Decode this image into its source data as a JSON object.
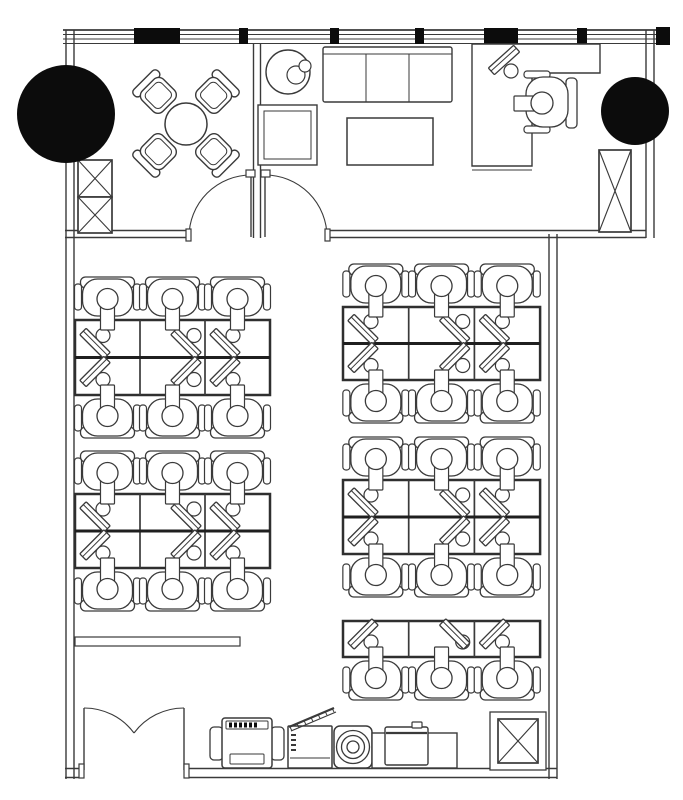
{
  "plan": {
    "canvas": {
      "width": 683,
      "height": 800
    },
    "palette": {
      "background": "#ffffff",
      "line": "#3a3a3a",
      "line_heavy": "#1f1f1f",
      "black_fill": "#0c0c0c",
      "bank_border": "#2f2f2f",
      "white": "#ffffff"
    },
    "window_band": {
      "x1": 63,
      "x2": 656,
      "ys": [
        30,
        34.5,
        39,
        43.5
      ]
    },
    "wall_black_segments": [
      [
        134,
        28,
        46,
        16
      ],
      [
        239,
        28,
        9,
        16
      ],
      [
        330,
        28,
        9,
        16
      ],
      [
        415,
        28,
        9,
        16
      ],
      [
        484,
        28,
        34,
        16
      ],
      [
        577,
        28,
        10,
        16
      ],
      [
        656,
        27,
        14,
        18
      ]
    ],
    "walls": [
      {
        "name": "left-wall",
        "x1": 70,
        "y1": 30,
        "x2": 70,
        "y2": 779,
        "gap": 8
      },
      {
        "name": "upper-right-wall",
        "x1": 650,
        "y1": 30,
        "x2": 650,
        "y2": 238,
        "gap": 8
      },
      {
        "name": "interior-wall-left",
        "x1": 65,
        "y1": 234,
        "x2": 189,
        "y2": 234,
        "gap": 7
      },
      {
        "name": "interior-wall-right",
        "x1": 327,
        "y1": 234,
        "x2": 646,
        "y2": 234,
        "gap": 7
      },
      {
        "name": "room-divider-wall",
        "x1": 257,
        "y1": 44,
        "x2": 257,
        "y2": 238,
        "gap": 7
      },
      {
        "name": "open-office-right-wall",
        "x1": 553,
        "y1": 234,
        "x2": 553,
        "y2": 779,
        "gap": 8
      },
      {
        "name": "bottom-wall-left",
        "x1": 65,
        "y1": 773,
        "x2": 84,
        "y2": 773,
        "gap": 9
      },
      {
        "name": "bottom-wall-right",
        "x1": 184,
        "y1": 773,
        "x2": 557,
        "y2": 773,
        "gap": 9
      }
    ],
    "columns": [
      {
        "name": "column-top-left",
        "cx": 66,
        "cy": 114,
        "r": 49
      },
      {
        "name": "column-top-right",
        "cx": 635,
        "cy": 111,
        "r": 34
      }
    ],
    "x_cabinets": [
      {
        "name": "storage-cabinet-left-upper",
        "x": 78,
        "y": 160,
        "w": 34,
        "h": 37
      },
      {
        "name": "storage-cabinet-left-lower",
        "x": 78,
        "y": 197,
        "w": 34,
        "h": 36
      },
      {
        "name": "storage-cabinet-office",
        "x": 599,
        "y": 150,
        "w": 32,
        "h": 82
      },
      {
        "name": "service-box",
        "x": 498,
        "y": 719,
        "w": 40,
        "h": 44,
        "outer": [
          490,
          712,
          56,
          58
        ]
      }
    ],
    "reception": {
      "table": {
        "cx": 186,
        "cy": 124,
        "r": 21
      },
      "chairs": [
        {
          "cx": 158,
          "cy": 95,
          "rot": -45
        },
        {
          "cx": 214,
          "cy": 95,
          "rot": 45
        },
        {
          "cx": 158,
          "cy": 152,
          "rot": -135
        },
        {
          "cx": 214,
          "cy": 152,
          "rot": 135
        }
      ]
    },
    "lounge": {
      "round_table": {
        "cx": 288,
        "cy": 72,
        "r": 22
      },
      "kettle": [
        {
          "cx": 296,
          "cy": 75,
          "r": 9
        },
        {
          "cx": 305,
          "cy": 66,
          "r": 6
        }
      ],
      "square_table": {
        "x": 258,
        "y": 105,
        "w": 59,
        "h": 60,
        "inset": 6
      },
      "sofa": {
        "x": 323,
        "y": 47,
        "w": 129,
        "h": 55,
        "seat_top": 54,
        "dividers": [
          366,
          409
        ]
      },
      "coffee_table": {
        "x": 347,
        "y": 118,
        "w": 86,
        "h": 47
      }
    },
    "office": {
      "desk_path": "M472 44 L600 44 L600 73 L532 73 L532 166 L472 166 Z",
      "desk_inner_line": [
        472,
        170,
        532,
        170
      ],
      "monitor": {
        "cx": 504,
        "cy": 60,
        "angle": -42,
        "circle": [
          511,
          71,
          6.5
        ]
      },
      "chair": {
        "cx": 546,
        "cy": 103
      },
      "keyboard": {
        "x": 514,
        "y": 96,
        "w": 22,
        "h": 15
      }
    },
    "desk_banks": [
      {
        "name": "desk-bank-left-top",
        "x": 75,
        "y": 320,
        "cols": 3,
        "rows": 2,
        "cell_w": 65,
        "cell_h": 37.5,
        "chairs": "both",
        "monitor_dx": [
          20,
          46,
          20
        ]
      },
      {
        "name": "desk-bank-left-bottom",
        "x": 75,
        "y": 494,
        "cols": 3,
        "rows": 2,
        "cell_w": 65,
        "cell_h": 37,
        "chairs": "both",
        "monitor_dx": [
          20,
          46,
          20
        ]
      },
      {
        "name": "desk-bank-right-top",
        "x": 343,
        "y": 307,
        "cols": 3,
        "rows": 2,
        "cell_w": 65.7,
        "cell_h": 36.5,
        "chairs": "both",
        "monitor_dx": [
          20,
          46,
          20
        ]
      },
      {
        "name": "desk-bank-right-middle",
        "x": 343,
        "y": 480,
        "cols": 3,
        "rows": 2,
        "cell_w": 65.7,
        "cell_h": 37,
        "chairs": "both",
        "monitor_dx": [
          20,
          46,
          20
        ]
      },
      {
        "name": "desk-bank-right-bottom",
        "x": 343,
        "y": 621,
        "cols": 3,
        "rows": 1,
        "cell_w": 65.7,
        "cell_h": 36,
        "chairs": "bottom",
        "monitor_dx": [
          20,
          46,
          20
        ],
        "monitor_angles": [
          -45,
          45,
          -45
        ]
      }
    ],
    "equipment": {
      "low_cabinet": {
        "x": 75,
        "y": 637,
        "w": 165,
        "h": 9
      },
      "copier": {
        "x": 210,
        "y": 718,
        "w": 74,
        "h": 50
      },
      "shredder": {
        "x": 288,
        "y": 726,
        "w": 44,
        "h": 42
      },
      "water_dispenser": {
        "x": 334,
        "y": 726,
        "w": 38,
        "h": 42,
        "rings": [
          16.5,
          11.5,
          6
        ]
      },
      "counter": {
        "x": 372,
        "y": 733,
        "w": 85,
        "h": 35
      },
      "appliance": {
        "x": 385,
        "y": 727,
        "w": 43,
        "h": 38,
        "nub": [
          412,
          722,
          10,
          6
        ]
      }
    },
    "doors": {
      "interior": [
        {
          "name": "reception-door",
          "leaf": [
            251,
            237,
            251,
            175
          ],
          "arc": "M189 237 A62 62 0 0 1 251 175",
          "jambs": [
            [
              246,
              170,
              9,
              7
            ],
            [
              186,
              229,
              5,
              12
            ]
          ]
        },
        {
          "name": "lounge-door",
          "leaf": [
            265,
            237,
            265,
            175
          ],
          "arc": "M327 237 A62 62 0 0 0 265 175",
          "jambs": [
            [
              261,
              170,
              9,
              7
            ],
            [
              325,
              229,
              5,
              12
            ]
          ]
        }
      ],
      "entry": [
        {
          "name": "entry-door-left-leaf",
          "leaf": [
            84,
            770,
            84,
            708
          ],
          "arc": "M84 708 A62 62 0 0 1 134 733",
          "jamb": [
            79,
            764,
            5,
            14
          ]
        },
        {
          "name": "entry-door-right-leaf",
          "leaf": [
            184,
            770,
            184,
            708
          ],
          "arc": "M184 708 A62 62 0 0 0 134 733",
          "jamb": [
            184,
            764,
            5,
            14
          ]
        }
      ]
    }
  }
}
